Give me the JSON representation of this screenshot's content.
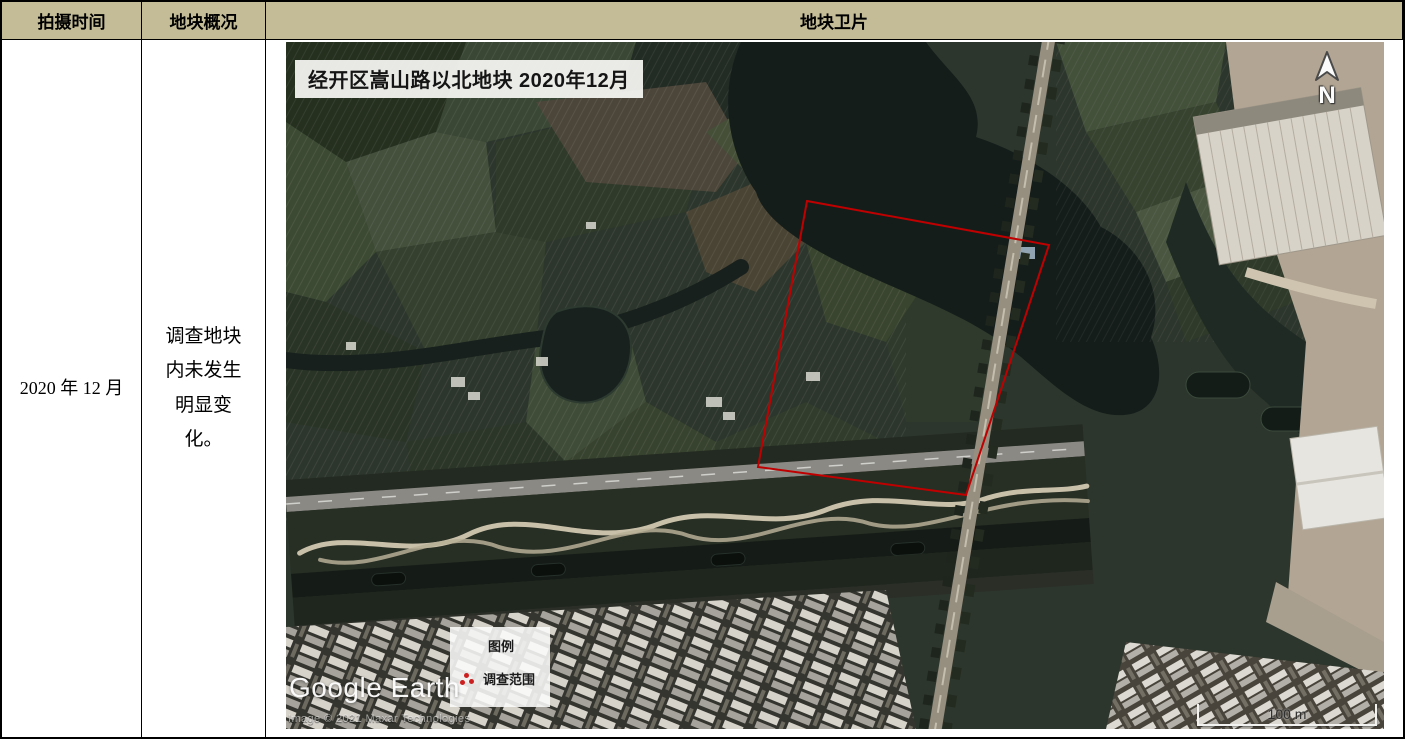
{
  "colors": {
    "header_bg": "#c3bc96",
    "border": "#000000",
    "survey_outline": "#c00000"
  },
  "table": {
    "headers": [
      {
        "label": "拍摄时间"
      },
      {
        "label": "地块概况"
      },
      {
        "label": "地块卫片"
      }
    ],
    "row": {
      "capture_time": "2020 年 12 月",
      "plot_overview": "调查地块内未发生明显变化。"
    }
  },
  "map": {
    "title_label": "经开区嵩山路以北地块 2020年12月",
    "north_arrow_label": "N",
    "legend": {
      "title": "图例",
      "items": [
        {
          "symbol": "red-dots-polygon",
          "label": "调查范围"
        }
      ]
    },
    "survey_polygon": {
      "points": "521,159 763,203 680,453 472,425",
      "color": "#c00000"
    },
    "watermark": "Google Earth",
    "copyright": "Image © 2021 Maxar Technologies",
    "scale_bar_label": "100 m"
  }
}
